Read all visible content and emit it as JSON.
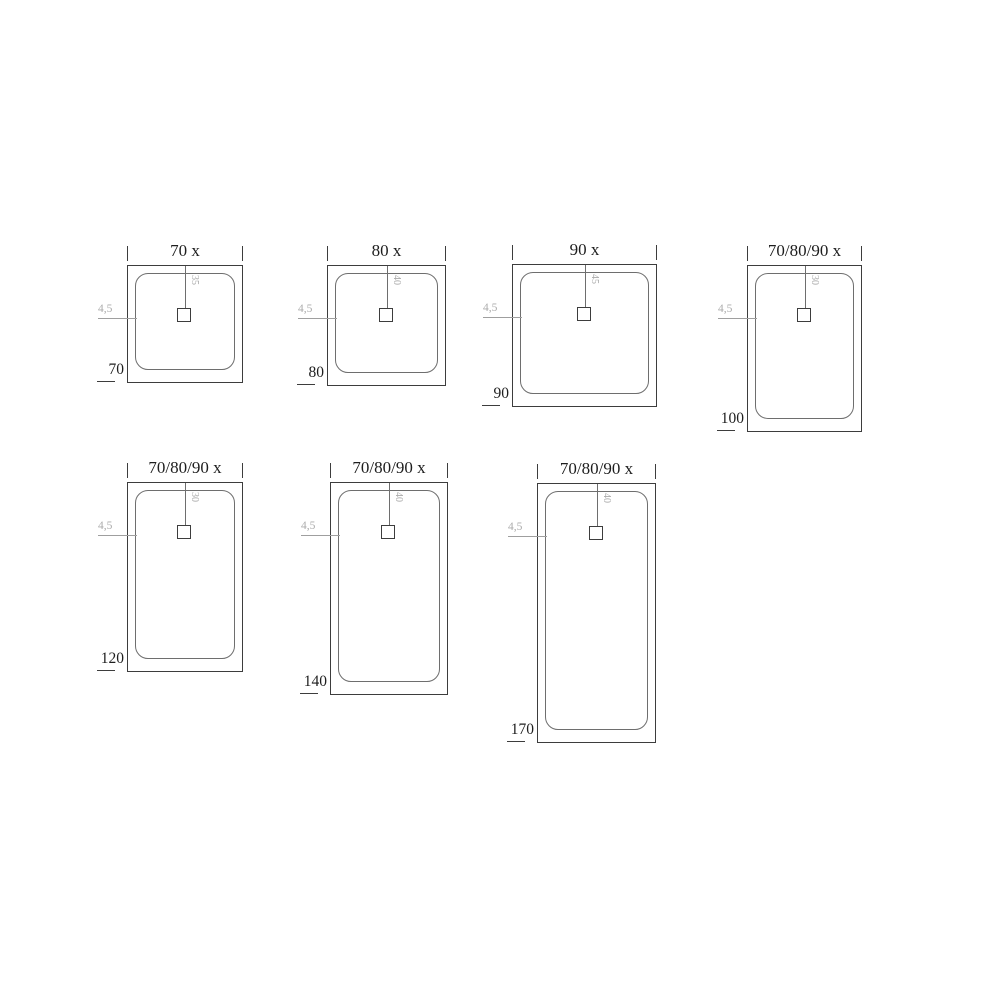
{
  "colors": {
    "background": "#ffffff",
    "line_dark": "#3d3d3d",
    "line_mid": "#6e6e6e",
    "line_light": "#9f9f9f",
    "text_dark": "#1e1e1e",
    "text_light": "#ababab"
  },
  "trays": [
    {
      "title": "70 x",
      "drain_offset": "35",
      "rim_label": "4,5",
      "side_label": "70",
      "geometry": {
        "x": 127,
        "y": 265,
        "w": 116,
        "h": 118
      }
    },
    {
      "title": "80 x",
      "drain_offset": "40",
      "rim_label": "4,5",
      "side_label": "80",
      "geometry": {
        "x": 327,
        "y": 265,
        "w": 119,
        "h": 121
      }
    },
    {
      "title": "90 x",
      "drain_offset": "45",
      "rim_label": "4,5",
      "side_label": "90",
      "geometry": {
        "x": 512,
        "y": 264,
        "w": 145,
        "h": 143
      }
    },
    {
      "title": "70/80/90 x",
      "drain_offset": "30",
      "rim_label": "4,5",
      "side_label": "100",
      "geometry": {
        "x": 747,
        "y": 265,
        "w": 115,
        "h": 167
      }
    },
    {
      "title": "70/80/90 x",
      "drain_offset": "30",
      "rim_label": "4,5",
      "side_label": "120",
      "geometry": {
        "x": 127,
        "y": 482,
        "w": 116,
        "h": 190
      }
    },
    {
      "title": "70/80/90 x",
      "drain_offset": "40",
      "rim_label": "4,5",
      "side_label": "140",
      "geometry": {
        "x": 330,
        "y": 482,
        "w": 118,
        "h": 213
      }
    },
    {
      "title": "70/80/90 x",
      "drain_offset": "40",
      "rim_label": "4,5",
      "side_label": "170",
      "geometry": {
        "x": 537,
        "y": 483,
        "w": 119,
        "h": 260
      }
    }
  ]
}
